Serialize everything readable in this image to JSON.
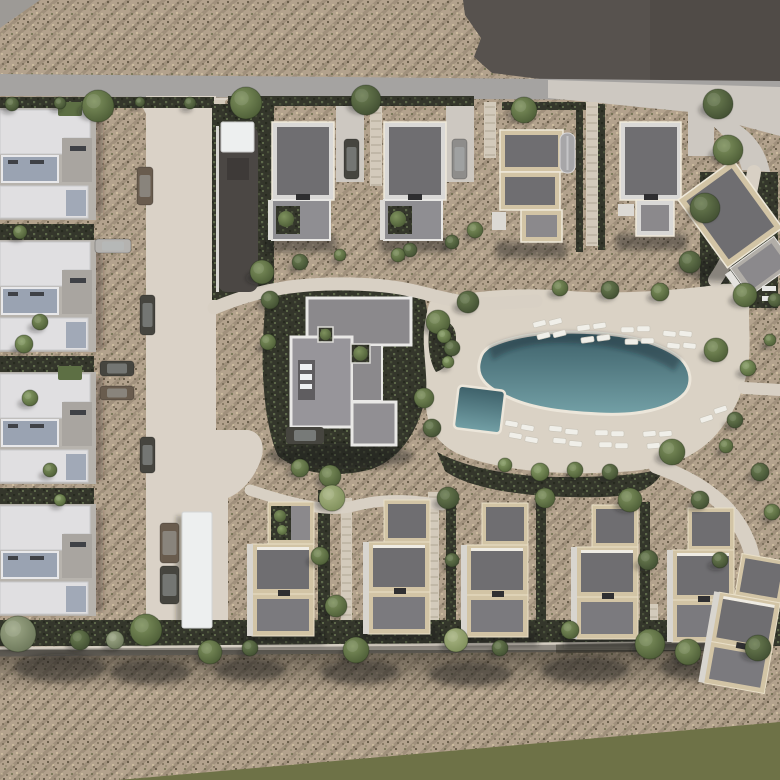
{
  "scene": {
    "description": "Aerial 3D render of a residential masterplan: left column of apartment blocks, two rows of detached villas, central clubhouse, freeform swimming pool with sun loungers, internal street, footpaths, scrubland and olive field strip",
    "canvas": {
      "width": 780,
      "height": 780
    }
  },
  "palette": {
    "scrubBase": "#b3a28d",
    "dot1": "#887b66",
    "dot2": "#6a5f4c",
    "dot3": "#cbbb9f",
    "dot4": "#9b9077",
    "dotGreen": "#7d7c5c",
    "rowTint": "rgba(90,84,64,0.22)",
    "field": "#6e7247",
    "roadGray": "#a5a3a1",
    "pavement": "#cdc8c1",
    "pathLight": "#d8d0c4",
    "internalRoad": "#dad2c7",
    "parcelDark": "#57524e",
    "parcelShade": "rgba(0,0,0,0.08)",
    "plantDark": "#34362b",
    "plantDot1": "#272a1f",
    "plantDot2": "#49503a",
    "plantDot3": "#5d684a",
    "poolTop": "#3d6069",
    "poolBottom": "#73a0a6",
    "poolEdge": "#ece6da",
    "poolShadow": "rgba(18,40,46,0.38)",
    "slabWhite": "#e0dfe1",
    "deckBlue": "#9aa3b2",
    "concrete": "#b7b3ad",
    "whiteRoof": "#edefef",
    "roofDark": "#6f6e71",
    "roofMid": "#8b898c",
    "roofLow": "#7b7a7e",
    "trimCream": "#d2c4a5",
    "trimLight": "#d9d8d6",
    "trimStroke": "#efe9da",
    "walkway": "#8f8a82",
    "walkwayEdge": "#d5cec2",
    "walkwayDark": "rgba(60,58,50,0.55)",
    "shadow": "rgba(30,28,22,0.42)",
    "carDark": "#46453f",
    "carGray": "#8e8d8b",
    "carBrown": "#695c4e",
    "carSilver": "#b5b3b0",
    "lounger": "#f0efe9",
    "loungerEdge": "#c9c4b8",
    "treeG1a": "#8aa068",
    "treeG1b": "#4f6036",
    "treeG2a": "#7f925e",
    "treeG2b": "#4a5a34",
    "treeG3a": "#6c7e52",
    "treeG3b": "#3f4c30",
    "treeGra": "#9fa988",
    "treeGrb": "#697457",
    "treeLia": "#aab684",
    "treeLib": "#7c8c58"
  },
  "geometry": {
    "field_pts": "118,780 780,722 780,780",
    "wedge_pts": "0,0 40,0 0,28",
    "parcel_pts": "463,0 780,0 780,92 556,81 492,73 474,57 481,38 465,15",
    "parcel_shade_pts": "650,0 780,0 780,90 650,83",
    "road_pts": "0,74 780,81 780,101 0,96",
    "pavement_pts": "548,80 780,87 780,136 690,112 548,98",
    "pave_branch_d": "M704,110 C742,120 764,140 770,172 L742,170 C736,144 716,126 698,116 Z",
    "internal_road": [
      146,
      96,
      70,
      338
    ],
    "flare_left_d": "M132,98 L146,98 L146,114 Q140,101 132,98 Z",
    "flare_right_d": "M230,98 L216,98 L216,114 Q222,101 230,98 Z",
    "plaza_d": "M146,430 L248,430 C262,432 266,448 260,462 C254,478 242,492 228,498 L228,632 L146,632 Z",
    "deck_d": "M430,302 C468,290 520,287 570,291 C618,295 678,290 716,285 C738,281 752,287 750,300 C747,316 752,342 748,366 C744,390 735,414 713,438 C689,462 658,470 618,472 C558,476 498,470 461,455 C436,445 424,423 426,395 C428,371 421,344 425,323 C427,312 428,306 430,302 Z",
    "pool_d": "M489,347 C513,335 553,330 597,333 C637,336 665,346 681,359 C691,369 693,383 685,393 C670,409 639,416 599,414 C557,412 528,407 508,397 C487,388 477,378 479,364 C481,353 484,351 489,347 Z",
    "pool_shadow_d": "M489,347 C513,335 553,330 597,333 C637,336 665,346 681,359 L674,371 C648,352 600,343 560,343 C530,343 506,350 493,360 Z",
    "kiddie_pool": {
      "x": 456,
      "y": 388,
      "w": 47,
      "h": 43,
      "rot": 7
    },
    "clubhouse_surround_d": "M266,290 C300,284 334,286 356,290 L424,295 C431,326 432,356 427,388 C421,428 402,458 372,469 C332,480 298,472 278,456 C266,430 261,380 263,338 Z",
    "pool_hedge_d": "M437,452 C468,469 518,477 560,477 C608,477 648,475 664,467 C659,486 638,497 600,497 C540,499 472,491 445,471 Z",
    "deck_pocket_d": "M432,320 C446,318 456,324 456,338 C456,354 448,368 436,372 C428,360 426,334 432,320 Z",
    "walkway_line": [
      0,
      652,
      748,
      646
    ],
    "dark_lane": {
      "x": 218,
      "y": 126,
      "w": 40,
      "h": 166,
      "cap": [
        221,
        122,
        33,
        30
      ],
      "inner": [
        227,
        158,
        22,
        22
      ]
    }
  },
  "paths": [
    {
      "d": "M214,308 C262,288 302,283 352,284 C402,285 420,293 448,299 C482,307 508,302 536,301",
      "w": 13
    },
    {
      "d": "M250,490 C300,507 332,512 354,506 C388,497 420,501 442,505",
      "w": 11
    },
    {
      "d": "M656,466 C708,484 738,512 750,548 C758,574 761,602 759,636",
      "w": 15
    },
    {
      "d": "M754,172 C748,208 737,248 715,280",
      "w": 14
    },
    {
      "d": "M744,388 L780,390",
      "w": 12
    }
  ],
  "driveways": [
    [
      336,
      100,
      28,
      82
    ],
    [
      446,
      100,
      28,
      82
    ],
    [
      688,
      100,
      26,
      56
    ]
  ],
  "steps": [
    [
      213,
      100,
      182,
      12
    ],
    [
      370,
      100,
      186,
      12
    ],
    [
      484,
      102,
      158,
      12
    ],
    [
      586,
      102,
      246,
      12
    ],
    [
      341,
      498,
      648,
      11
    ],
    [
      428,
      492,
      648,
      11
    ],
    [
      648,
      604,
      648,
      10
    ],
    [
      738,
      608,
      650,
      10
    ]
  ],
  "hedges": [
    [
      0,
      97,
      214,
      11
    ],
    [
      228,
      96,
      246,
      10
    ],
    [
      502,
      102,
      84,
      8
    ],
    [
      264,
      104,
      8,
      140
    ],
    [
      576,
      104,
      7,
      148
    ],
    [
      598,
      104,
      7,
      146
    ],
    [
      212,
      104,
      62,
      196
    ],
    [
      318,
      490,
      12,
      156
    ],
    [
      446,
      494,
      10,
      152
    ],
    [
      536,
      498,
      10,
      148
    ],
    [
      640,
      502,
      10,
      144
    ],
    [
      0,
      620,
      750,
      26
    ],
    [
      0,
      224,
      94,
      22
    ],
    [
      0,
      356,
      94,
      22
    ],
    [
      0,
      488,
      94,
      20
    ],
    [
      700,
      172,
      78,
      136
    ],
    [
      700,
      600,
      80,
      46
    ]
  ],
  "shadow_rects": [
    [
      266,
      236,
      70,
      16
    ],
    [
      380,
      236,
      70,
      16
    ],
    [
      496,
      242,
      70,
      16
    ],
    [
      616,
      234,
      70,
      16
    ],
    [
      244,
      628,
      80,
      16
    ],
    [
      360,
      626,
      80,
      16
    ],
    [
      458,
      630,
      80,
      16
    ],
    [
      564,
      632,
      80,
      16
    ],
    [
      660,
      634,
      80,
      16
    ]
  ],
  "shadow_blobs": [
    [
      60,
      668,
      46,
      14
    ],
    [
      150,
      672,
      40,
      12
    ],
    [
      250,
      670,
      36,
      11
    ],
    [
      360,
      672,
      40,
      12
    ],
    [
      470,
      674,
      42,
      12
    ],
    [
      585,
      670,
      44,
      13
    ],
    [
      700,
      668,
      40,
      12
    ],
    [
      340,
      456,
      74,
      13
    ],
    [
      724,
      270,
      40,
      12
    ]
  ],
  "apartments": {
    "x": 0,
    "ys": [
      108,
      240,
      372,
      504
    ]
  },
  "top_houses": [
    {
      "x": 272,
      "y": 122,
      "type": "std",
      "trim": "trimLight"
    },
    {
      "x": 384,
      "y": 122,
      "type": "std",
      "trim": "trimLight"
    },
    {
      "x": 500,
      "y": 130,
      "type": "h3",
      "trim": "trimCream"
    },
    {
      "x": 620,
      "y": 122,
      "type": "h4",
      "trim": "trimLight"
    },
    {
      "x": 742,
      "y": 230,
      "type": "rot",
      "trim": "trimCream",
      "rot": -36
    }
  ],
  "bottom_houses": [
    {
      "x": 252,
      "y": 502,
      "green": true
    },
    {
      "x": 368,
      "y": 500,
      "green": false
    },
    {
      "x": 466,
      "y": 503,
      "green": false
    },
    {
      "x": 576,
      "y": 505,
      "green": false
    },
    {
      "x": 672,
      "y": 508,
      "green": false
    },
    {
      "x": -30,
      "y": 0,
      "green": false,
      "tx": 756,
      "ty": 556,
      "rot": 10
    }
  ],
  "clubhouse": {
    "bar": [
      307,
      298,
      104,
      47
    ],
    "left_block": [
      291,
      337,
      61,
      90
    ],
    "court": [
      298,
      360,
      17,
      40
    ],
    "skylights": [
      [
        300,
        364,
        12,
        6
      ],
      [
        300,
        374,
        12,
        6
      ],
      [
        300,
        384,
        12,
        5
      ]
    ],
    "right_block": [
      352,
      345,
      30,
      56
    ],
    "bottom_block": [
      352,
      402,
      44,
      43
    ],
    "green_boxes": [
      [
        318,
        327,
        15,
        15
      ],
      [
        351,
        344,
        19,
        19
      ]
    ],
    "car": [
      286,
      427,
      38,
      17
    ]
  },
  "structures": {
    "carport": [
      182,
      512,
      30,
      116
    ],
    "barrel_roof": [
      560,
      133,
      15,
      40
    ],
    "white_bits": [
      [
        762,
        286,
        14,
        5
      ],
      [
        762,
        296,
        14,
        5
      ]
    ]
  },
  "cars": [
    [
      344,
      139,
      15,
      40,
      "carDark"
    ],
    [
      452,
      139,
      15,
      40,
      "carGray"
    ],
    [
      137,
      167,
      16,
      38,
      "carBrown"
    ],
    [
      95,
      239,
      36,
      14,
      "carSilver"
    ],
    [
      140,
      295,
      15,
      40,
      "carDark"
    ],
    [
      100,
      361,
      34,
      15,
      "carDark"
    ],
    [
      100,
      386,
      34,
      14,
      "carBrown"
    ],
    [
      140,
      437,
      15,
      36,
      "carDark"
    ],
    [
      160,
      523,
      19,
      40,
      "carBrown"
    ],
    [
      160,
      566,
      19,
      38,
      "carDark"
    ]
  ],
  "loungers": [
    [
      533,
      321,
      -14
    ],
    [
      549,
      319,
      -14
    ],
    [
      537,
      333,
      -14
    ],
    [
      553,
      331,
      -14
    ],
    [
      577,
      325,
      -8
    ],
    [
      593,
      323,
      -8
    ],
    [
      581,
      337,
      -8
    ],
    [
      597,
      335,
      -8
    ],
    [
      621,
      327,
      0
    ],
    [
      637,
      326,
      0
    ],
    [
      625,
      339,
      0
    ],
    [
      641,
      338,
      0
    ],
    [
      663,
      331,
      6
    ],
    [
      679,
      331,
      6
    ],
    [
      667,
      343,
      6
    ],
    [
      683,
      343,
      6
    ],
    [
      505,
      421,
      10
    ],
    [
      521,
      425,
      10
    ],
    [
      509,
      433,
      10
    ],
    [
      525,
      437,
      10
    ],
    [
      549,
      426,
      5
    ],
    [
      565,
      429,
      5
    ],
    [
      553,
      438,
      5
    ],
    [
      569,
      441,
      5
    ],
    [
      595,
      430,
      0
    ],
    [
      611,
      431,
      0
    ],
    [
      599,
      442,
      0
    ],
    [
      615,
      443,
      0
    ],
    [
      643,
      431,
      -5
    ],
    [
      659,
      431,
      -5
    ],
    [
      647,
      443,
      -5
    ],
    [
      663,
      443,
      -5
    ],
    [
      700,
      416,
      -18
    ],
    [
      714,
      407,
      -18
    ]
  ],
  "trees": [
    [
      98,
      106,
      16,
      "g2"
    ],
    [
      246,
      103,
      16,
      "g2"
    ],
    [
      366,
      100,
      15,
      "g3"
    ],
    [
      524,
      110,
      13,
      "g2"
    ],
    [
      718,
      104,
      15,
      "g3"
    ],
    [
      12,
      104,
      7,
      "g3"
    ],
    [
      60,
      103,
      6,
      "g3"
    ],
    [
      140,
      102,
      5,
      "g3"
    ],
    [
      190,
      103,
      6,
      "g3"
    ],
    [
      262,
      272,
      12,
      "g2"
    ],
    [
      300,
      262,
      8,
      "g3"
    ],
    [
      340,
      255,
      6,
      "g2"
    ],
    [
      410,
      250,
      7,
      "g3"
    ],
    [
      452,
      242,
      7,
      "g3"
    ],
    [
      475,
      230,
      8,
      "g2"
    ],
    [
      728,
      150,
      15,
      "g2"
    ],
    [
      705,
      208,
      15,
      "g3"
    ],
    [
      690,
      262,
      11,
      "g3"
    ],
    [
      745,
      295,
      12,
      "g2"
    ],
    [
      270,
      300,
      9,
      "g3"
    ],
    [
      268,
      342,
      8,
      "g2"
    ],
    [
      438,
      322,
      12,
      "g2"
    ],
    [
      452,
      348,
      8,
      "g3"
    ],
    [
      424,
      398,
      10,
      "g2"
    ],
    [
      432,
      428,
      9,
      "g3"
    ],
    [
      300,
      468,
      9,
      "g2"
    ],
    [
      330,
      476,
      11,
      "g2"
    ],
    [
      398,
      255,
      7,
      "g2"
    ],
    [
      468,
      302,
      11,
      "g3"
    ],
    [
      560,
      288,
      8,
      "g2"
    ],
    [
      610,
      290,
      9,
      "g3"
    ],
    [
      660,
      292,
      9,
      "g2"
    ],
    [
      444,
      336,
      7,
      "g1"
    ],
    [
      448,
      362,
      6,
      "g1"
    ],
    [
      672,
      452,
      13,
      "g2"
    ],
    [
      540,
      472,
      9,
      "g1"
    ],
    [
      575,
      470,
      8,
      "g2"
    ],
    [
      505,
      465,
      7,
      "g1"
    ],
    [
      610,
      472,
      8,
      "g3"
    ],
    [
      716,
      350,
      12,
      "g2"
    ],
    [
      748,
      368,
      8,
      "g1"
    ],
    [
      735,
      420,
      8,
      "g3"
    ],
    [
      726,
      446,
      7,
      "g2"
    ],
    [
      760,
      472,
      9,
      "g3"
    ],
    [
      772,
      512,
      8,
      "g2"
    ],
    [
      332,
      498,
      13,
      "li"
    ],
    [
      320,
      556,
      9,
      "g2"
    ],
    [
      336,
      606,
      11,
      "g2"
    ],
    [
      356,
      650,
      13,
      "g2"
    ],
    [
      448,
      498,
      11,
      "g3"
    ],
    [
      452,
      560,
      7,
      "g3"
    ],
    [
      456,
      640,
      12,
      "li"
    ],
    [
      545,
      498,
      10,
      "g2"
    ],
    [
      630,
      500,
      12,
      "g2"
    ],
    [
      648,
      560,
      10,
      "g3"
    ],
    [
      650,
      644,
      15,
      "g2"
    ],
    [
      700,
      500,
      9,
      "g3"
    ],
    [
      688,
      652,
      13,
      "g2"
    ],
    [
      758,
      648,
      13,
      "g3"
    ],
    [
      720,
      560,
      8,
      "g3"
    ],
    [
      18,
      634,
      18,
      "gr"
    ],
    [
      80,
      640,
      10,
      "g3"
    ],
    [
      115,
      640,
      9,
      "gr"
    ],
    [
      146,
      630,
      16,
      "g2"
    ],
    [
      210,
      652,
      12,
      "g2"
    ],
    [
      250,
      648,
      8,
      "g3"
    ],
    [
      570,
      630,
      9,
      "g2"
    ],
    [
      500,
      648,
      8,
      "g3"
    ],
    [
      24,
      344,
      9,
      "g1"
    ],
    [
      40,
      322,
      8,
      "g2"
    ],
    [
      30,
      398,
      8,
      "g1"
    ],
    [
      50,
      470,
      7,
      "g2"
    ],
    [
      20,
      232,
      7,
      "g2"
    ],
    [
      60,
      500,
      6,
      "g1"
    ],
    [
      775,
      300,
      7,
      "g3"
    ],
    [
      770,
      340,
      6,
      "g2"
    ]
  ]
}
